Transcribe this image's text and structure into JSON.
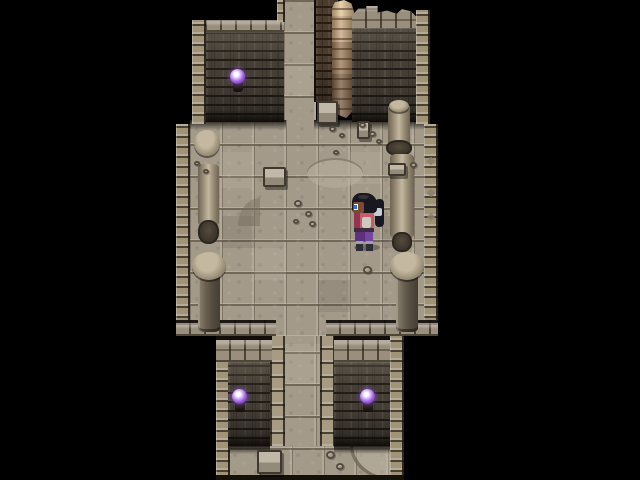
{
  "scene": {
    "title": "Ruined stone dungeon chamber with exits north and south, collapsed wall, broken pillars and a lone adventurer",
    "resolution": {
      "width": 640,
      "height": 480
    },
    "tile_size": 32,
    "rooms": {
      "north_corridor": {
        "x": 284,
        "y": 0,
        "width": 32,
        "height": 128
      },
      "main_hall": {
        "x": 176,
        "y": 120,
        "width": 262,
        "height": 216
      },
      "south_corridor": {
        "x": 270,
        "y": 316,
        "width": 65,
        "height": 132
      },
      "south_chamber": {
        "x": 216,
        "y": 336,
        "width": 188,
        "height": 144
      }
    },
    "player": {
      "x": 348,
      "y": 192,
      "facing": "left",
      "description": "girl sprite with black ponytail, dark skin, pink-red top, purple skirt, dark boots with grey cuffs"
    },
    "orbs": [
      {
        "x": 238,
        "y": 77
      },
      {
        "x": 240,
        "y": 397
      },
      {
        "x": 368,
        "y": 397
      }
    ],
    "pebbles": [
      {
        "x": 294,
        "y": 200,
        "s": 8
      },
      {
        "x": 305,
        "y": 211,
        "s": 7
      },
      {
        "x": 293,
        "y": 219,
        "s": 6
      },
      {
        "x": 309,
        "y": 221,
        "s": 7
      },
      {
        "x": 329,
        "y": 126,
        "s": 7
      },
      {
        "x": 339,
        "y": 133,
        "s": 6
      },
      {
        "x": 359,
        "y": 122,
        "s": 7
      },
      {
        "x": 369,
        "y": 131,
        "s": 7
      },
      {
        "x": 376,
        "y": 139,
        "s": 6
      },
      {
        "x": 333,
        "y": 150,
        "s": 6
      },
      {
        "x": 363,
        "y": 266,
        "s": 9
      },
      {
        "x": 194,
        "y": 161,
        "s": 6
      },
      {
        "x": 203,
        "y": 169,
        "s": 6
      },
      {
        "x": 326,
        "y": 451,
        "s": 9
      },
      {
        "x": 336,
        "y": 463,
        "s": 8
      },
      {
        "x": 410,
        "y": 162,
        "s": 7
      }
    ],
    "slabs": [
      {
        "x": 263,
        "y": 167,
        "w": 23,
        "h": 20
      },
      {
        "x": 357,
        "y": 121,
        "w": 13,
        "h": 18
      },
      {
        "x": 317,
        "y": 101,
        "w": 21,
        "h": 23
      },
      {
        "x": 388,
        "y": 163,
        "w": 18,
        "h": 13
      },
      {
        "x": 257,
        "y": 450,
        "w": 25,
        "h": 24
      }
    ]
  },
  "palette": {
    "bg": "#000000",
    "floor-base": "#a39a8a",
    "trim-base": "#a09378",
    "cap-base": "#9a8e7c",
    "cap-dark": "#4e4639",
    "brick-base": "#453e35",
    "brick-mortar": "#211c17",
    "ruin-base": "#4a3b2d",
    "ruin-mortar": "#261d14",
    "ruin-light": "#c9a77d",
    "ruin-mid": "#9c7b58",
    "pillar-light": "#c4b8a0",
    "pillar-base": "#a1957e",
    "pillar-dark": "#6e6352",
    "orb-core": "#ffffff",
    "orb-glow": "#a766e8",
    "orb-rim": "#4e2a85",
    "sconce": "#231d16",
    "char-hair": "#191820",
    "char-skin": "#7c4b32",
    "char-eye": "#3a6fd8",
    "char-shirt": "#c45d6e",
    "char-shirt-dark": "#943350",
    "char-pants": "#5e3080",
    "char-pants-light": "#74459c",
    "char-boot": "#2e2d35",
    "char-boot-cuff": "#9ea0a8",
    "char-tie": "#c9ccd4",
    "char-belt": "#3f2a3e",
    "char-pouch": "#cfc8bd"
  }
}
